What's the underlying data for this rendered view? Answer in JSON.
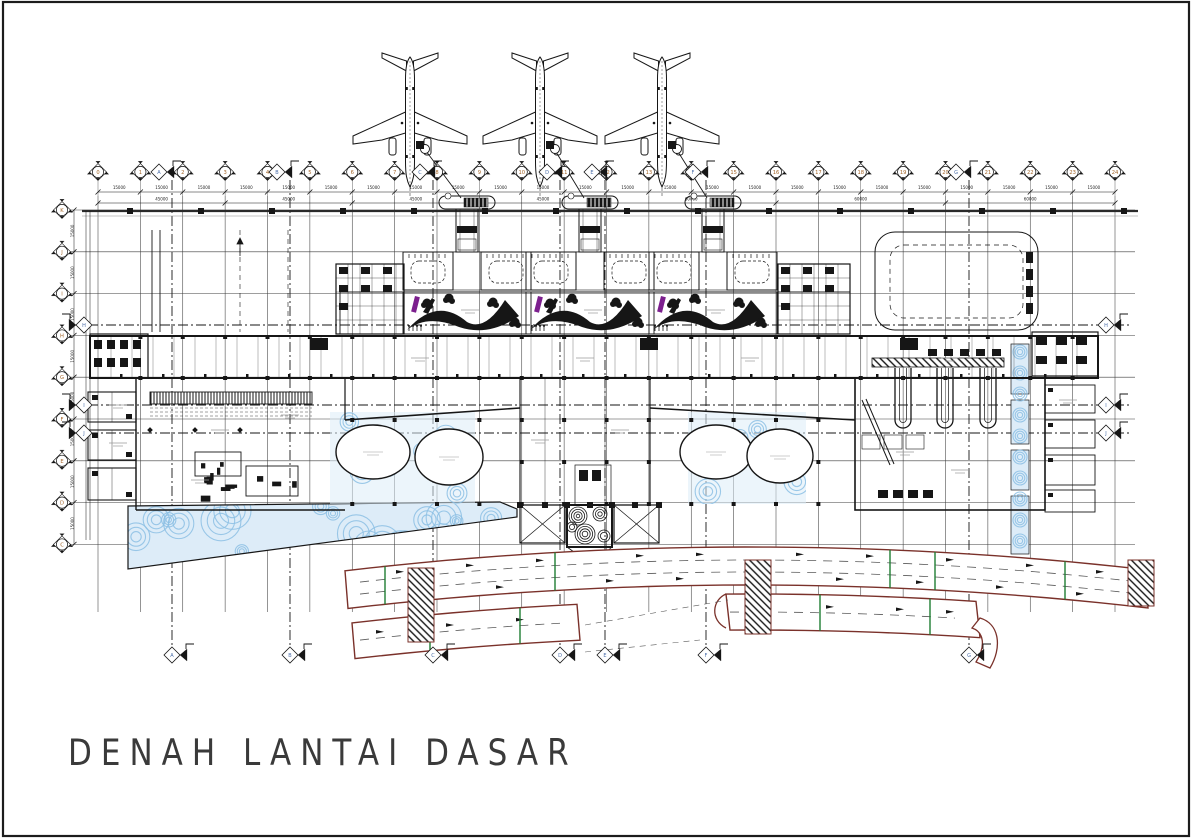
{
  "title": {
    "text": "DENAH LANTAI DASAR"
  },
  "colors": {
    "ink": "#161616",
    "faint": "#555555",
    "water_fill": "#ddecf8",
    "water_line": "#8cc0e4",
    "escalator": "#7c1f8e",
    "road_edge": "#7a312a",
    "road_dash": "#5a5a5a",
    "green_mark": "#1e7d32",
    "label_orange": "#a4662a",
    "label_blue": "#4a6da8"
  },
  "grid": {
    "top_bubbles": [
      "0",
      "1",
      "2",
      "3",
      "4",
      "5",
      "6",
      "7",
      "8",
      "9",
      "10",
      "11",
      "12",
      "13",
      "14",
      "15",
      "16",
      "17",
      "18",
      "19",
      "20",
      "21",
      "22",
      "23",
      "24"
    ],
    "left_bubbles": [
      "K",
      "J",
      "I",
      "H",
      "G",
      "F",
      "E",
      "D",
      "C"
    ],
    "bay_dim": "15000",
    "group_dim_left": "45000",
    "group_dim_right": "60000",
    "joint_flags_vertical": [
      "A",
      "B",
      "C",
      "D",
      "E",
      "F",
      "G"
    ],
    "joint_flags_horizontal": [
      "H",
      "I",
      "J"
    ]
  },
  "objects": {
    "aircraft_count": 3,
    "gate_count": 3,
    "baggage_carousel_count": 3
  }
}
